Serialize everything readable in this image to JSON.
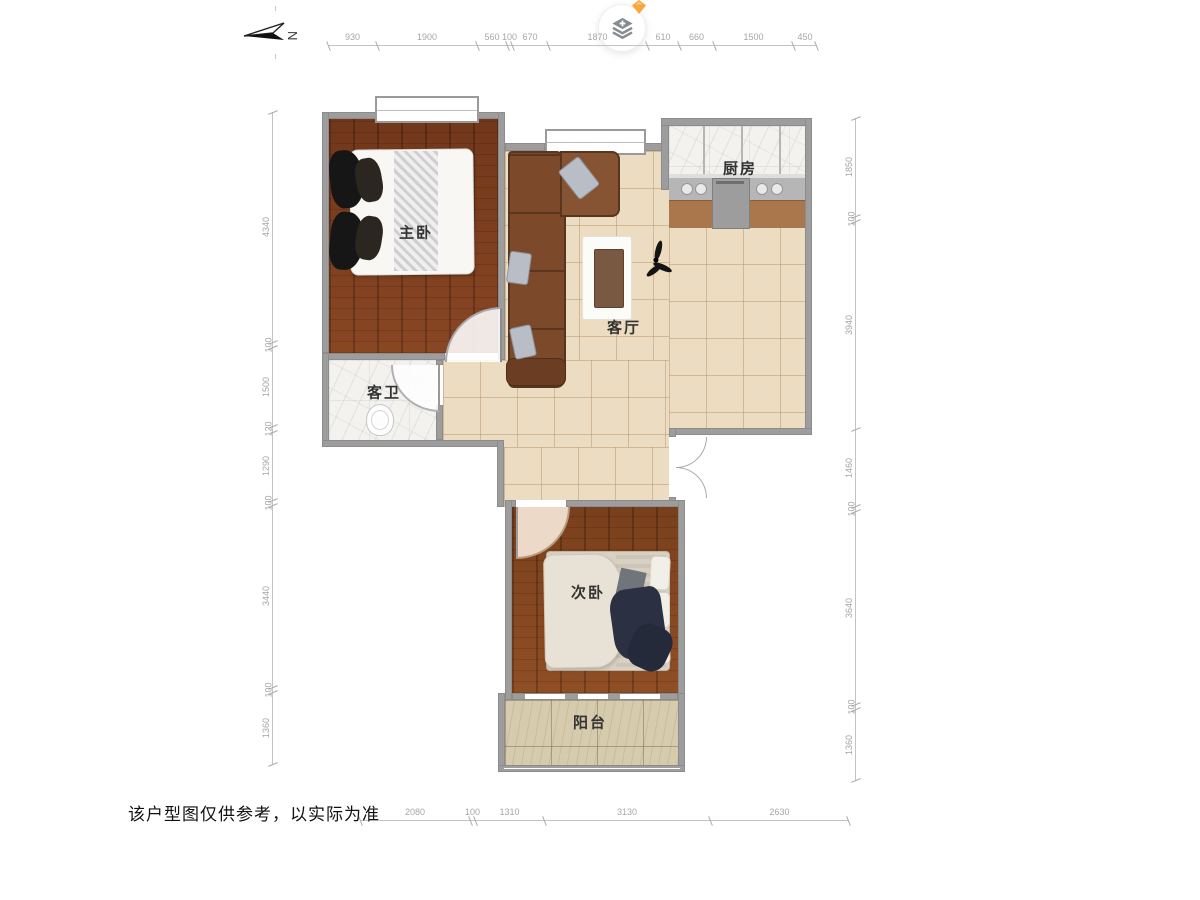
{
  "disclaimer": "该户型图仅供参考，以实际为准",
  "compass": {
    "north_label": "N"
  },
  "rooms": {
    "master_bedroom": "主卧",
    "guest_bathroom": "客卫",
    "living_room": "客厅",
    "kitchen": "厨房",
    "second_bedroom": "次卧",
    "balcony": "阳台"
  },
  "dimensions": {
    "top": [
      "930",
      "1900",
      "560",
      "100",
      "670",
      "1870",
      "610",
      "660",
      "1500",
      "450"
    ],
    "left": [
      "4340",
      "100",
      "1500",
      "120",
      "1290",
      "100",
      "3440",
      "100",
      "1360"
    ],
    "right": [
      "1850",
      "100",
      "3940",
      "1460",
      "100",
      "3640",
      "100",
      "1360"
    ],
    "bottom": [
      "2080",
      "100",
      "1310",
      "3130",
      "2630"
    ]
  },
  "colors": {
    "wood_floor": "#7b3c1d",
    "tile_floor": "#ecdcc1",
    "balcony_floor": "#d7cbae",
    "marble_floor": "#f3f2ef",
    "wall": "#9d9d9d",
    "sofa": "#7c4a2b",
    "badge_accent": "#f6a73e",
    "dimension_text": "#a6a6a6"
  }
}
